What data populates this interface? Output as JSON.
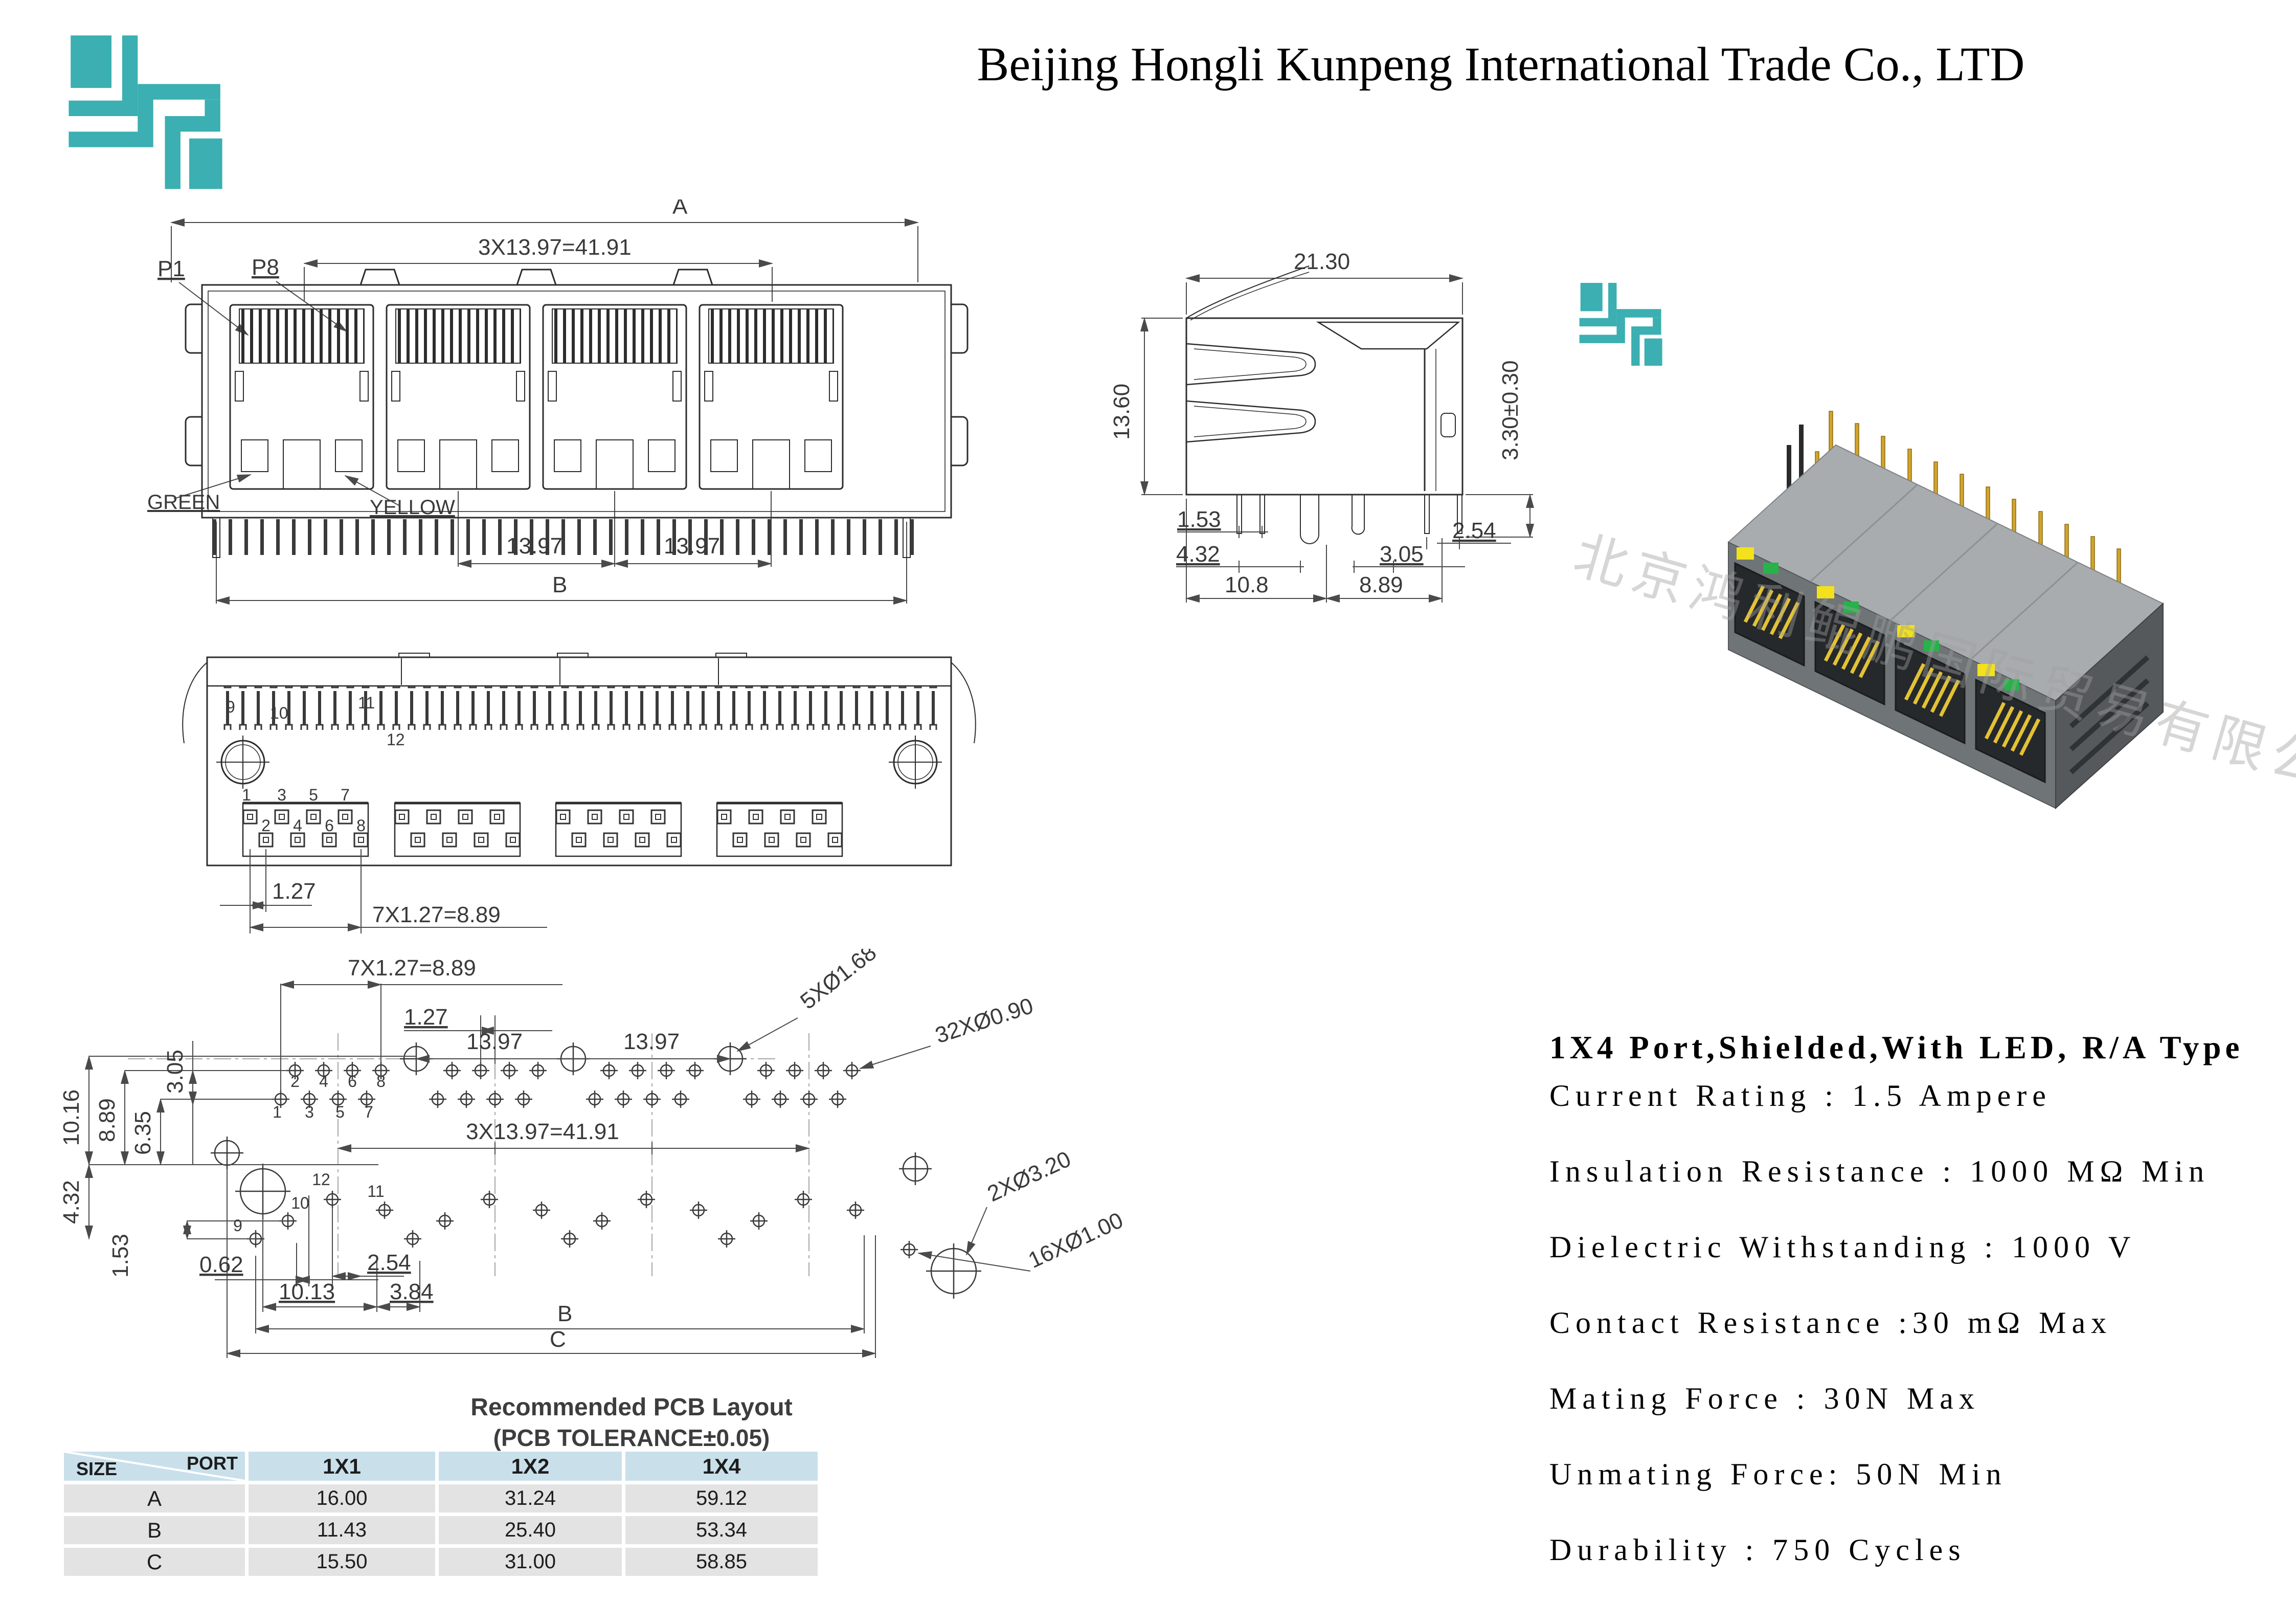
{
  "page": {
    "title": "Beijing Hongli Kunpeng International Trade Co., LTD"
  },
  "watermark": {
    "text": "北京鸿利鲲鹏国际贸易有限公司"
  },
  "colors": {
    "logo_teal": "#3BAFB1",
    "table_header_bg": "#c9e0eb",
    "table_row_bg": "#e3e3e4",
    "pin_gold": "#d2a42c",
    "led_yellow": "#f3e11c",
    "led_green": "#27b24a"
  },
  "front_view": {
    "a": "A",
    "total": "3X13.97=41.91",
    "p1": "P1",
    "p8": "P8",
    "green": "GREEN",
    "yellow": "YELLOW",
    "pitch1": "13.97",
    "pitch2": "13.97",
    "b": "B"
  },
  "side_view": {
    "w": "21.30",
    "h": "13.60",
    "standoff": "3.30±0.30",
    "d153": "1.53",
    "d254": "2.54",
    "d432": "4.32",
    "d305": "3.05",
    "d108": "10.8",
    "d889": "8.89"
  },
  "bottom_view": {
    "n9": "9",
    "n10": "10",
    "n11": "11",
    "n12": "12",
    "odd": [
      "1",
      "3",
      "5",
      "7"
    ],
    "even": [
      "2",
      "4",
      "6",
      "8"
    ],
    "d127": "1.27",
    "dtotal": "7X1.27=8.89"
  },
  "pcb": {
    "d7x": "7X1.27=8.89",
    "d127": "1.27",
    "p1397a": "13.97",
    "p1397b": "13.97",
    "h168": "5XØ1.68",
    "h090": "32XØ0.90",
    "h320": "2XØ3.20",
    "h100": "16XØ1.00",
    "d305": "3.05",
    "d1016": "10.16",
    "d889": "8.89",
    "d635": "6.35",
    "dtotal": "3X13.97=41.91",
    "d432": "4.32",
    "d153": "1.53",
    "d062": "0.62",
    "d254": "2.54",
    "d1013": "10.13",
    "d384": "3.84",
    "b": "B",
    "c": "C",
    "n1": "1",
    "n2": "2",
    "n3": "3",
    "n4": "4",
    "n5": "5",
    "n6": "6",
    "n7": "7",
    "n8": "8",
    "n9": "9",
    "n10": "10",
    "n11": "11",
    "n12": "12",
    "caption1": "Recommended PCB Layout",
    "caption2": "(PCB TOLERANCE±0.05)"
  },
  "specs": {
    "title": "1X4 Port,Shielded,With LED,  R/A Type",
    "items": [
      "Current Rating : 1.5 Ampere",
      "Insulation Resistance : 1000 MΩ Min",
      "Dielectric Withstanding : 1000 V",
      "Contact Resistance :30 mΩ Max",
      "Mating Force : 30N Max",
      "Unmating Force: 50N Min",
      "Durability : 750 Cycles"
    ]
  },
  "size_table": {
    "corner_port": "PORT",
    "corner_size": "SIZE",
    "col1": "1X1",
    "col2": "1X2",
    "col3": "1X4",
    "rows": [
      {
        "label": "A",
        "v1": "16.00",
        "v2": "31.24",
        "v3": "59.12"
      },
      {
        "label": "B",
        "v1": "11.43",
        "v2": "25.40",
        "v3": "53.34"
      },
      {
        "label": "C",
        "v1": "15.50",
        "v2": "31.00",
        "v3": "58.85"
      }
    ]
  }
}
